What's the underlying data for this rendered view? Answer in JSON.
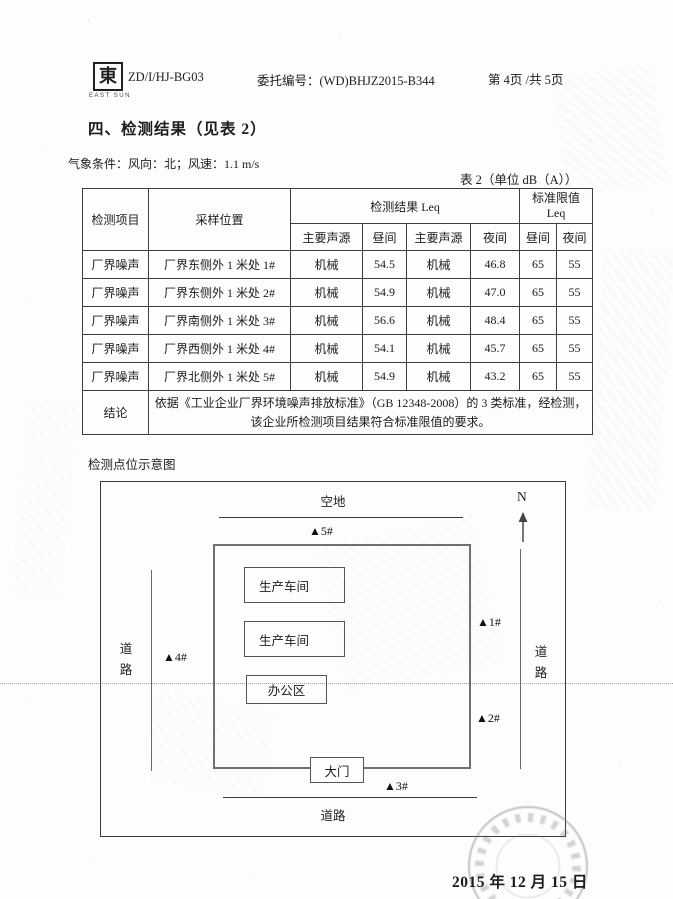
{
  "header": {
    "logo_glyph": "東",
    "logo_caption": "EAST SUN",
    "doc_code": "ZD/I/HJ-BG03",
    "commission": "委托编号：(WD)BHJZ2015-B344",
    "page_info": "第 4页 /共 5页"
  },
  "section_title": "四、检测结果（见表 2）",
  "weather": "气象条件：风向：北；风速：1.1 m/s",
  "table": {
    "caption": "表 2（单位 dB（A））",
    "headers": {
      "item": "检测项目",
      "position": "采样位置",
      "result_group": "检测结果 Leq",
      "limit_group_line1": "标准限值",
      "limit_group_line2": "Leq",
      "sub": [
        "主要声源",
        "昼间",
        "主要声源",
        "夜间",
        "昼间",
        "夜间"
      ]
    },
    "rows": [
      {
        "item": "厂界噪声",
        "position": "厂界东侧外 1 米处 1#",
        "source_day": "机械",
        "day": "54.5",
        "source_night": "机械",
        "night": "46.8",
        "limit_day": "65",
        "limit_night": "55"
      },
      {
        "item": "厂界噪声",
        "position": "厂界东侧外 1 米处 2#",
        "source_day": "机械",
        "day": "54.9",
        "source_night": "机械",
        "night": "47.0",
        "limit_day": "65",
        "limit_night": "55"
      },
      {
        "item": "厂界噪声",
        "position": "厂界南侧外 1 米处 3#",
        "source_day": "机械",
        "day": "56.6",
        "source_night": "机械",
        "night": "48.4",
        "limit_day": "65",
        "limit_night": "55"
      },
      {
        "item": "厂界噪声",
        "position": "厂界西侧外 1 米处 4#",
        "source_day": "机械",
        "day": "54.1",
        "source_night": "机械",
        "night": "45.7",
        "limit_day": "65",
        "limit_night": "55"
      },
      {
        "item": "厂界噪声",
        "position": "厂界北侧外 1 米处 5#",
        "source_day": "机械",
        "day": "54.9",
        "source_night": "机械",
        "night": "43.2",
        "limit_day": "65",
        "limit_night": "55"
      }
    ],
    "conclusion_label": "结论",
    "conclusion_text": "依据《工业企业厂界环境噪声排放标准》（GB 12348-2008）的 3 类标准，经检测，该企业所检测项目结果符合标准限值的要求。"
  },
  "diagram": {
    "title": "检测点位示意图",
    "open_space": "空地",
    "north_label": "N",
    "road_left": "道路",
    "road_right": "道路",
    "road_bottom": "道路",
    "workshop_1": "生产车间",
    "workshop_2": "生产车间",
    "office": "办公区",
    "gate": "大门",
    "marker_1": "▲1#",
    "marker_2": "▲2#",
    "marker_3": "▲3#",
    "marker_4": "▲4#",
    "marker_5": "▲5#"
  },
  "footer": {
    "date": "2015 年 12 月 15 日"
  }
}
